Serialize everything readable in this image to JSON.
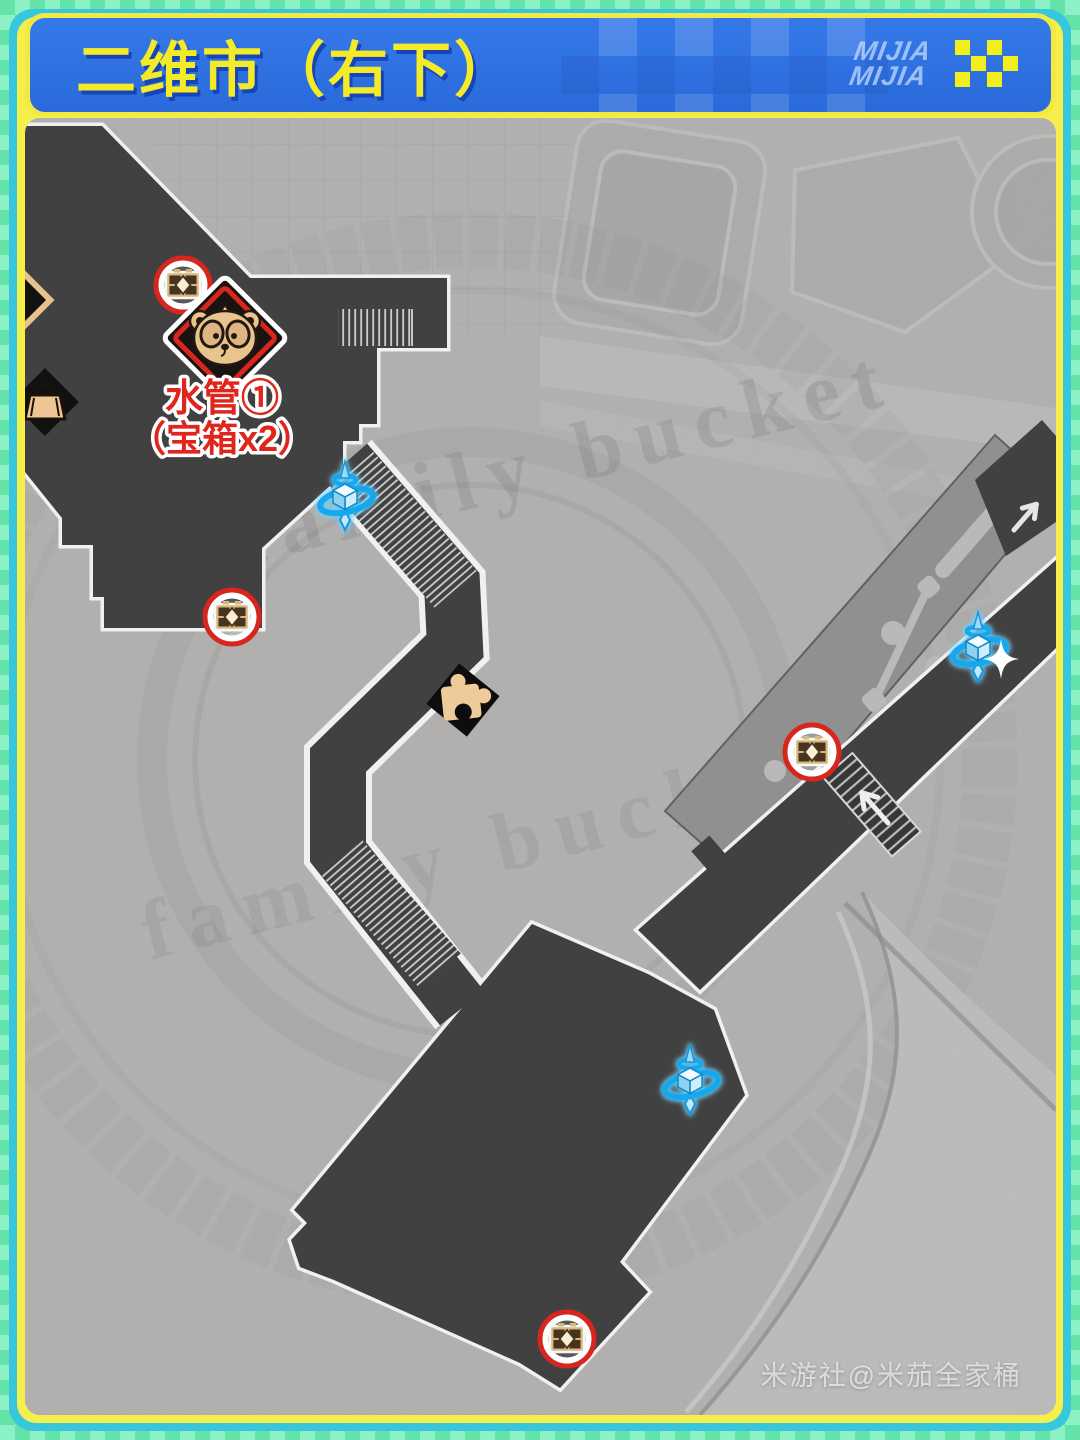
{
  "page": {
    "outer_green": "#63e3a8",
    "outer_green_light": "#8df1c6",
    "frame_cyan": "#38c5de",
    "frame_yellow": "#f6ef4b"
  },
  "header": {
    "title": "二维市（右下）",
    "title_color": "#f3ea28",
    "bg_color": "#2e72e2",
    "brand_line1": "MIJIA",
    "brand_line2": "MIJIA",
    "flower_color": "#f2ef19"
  },
  "map": {
    "ground_watermark": "family bucket",
    "label_line1": "水管①",
    "label_line2": "（宝箱x2）",
    "label_color": "#e0251c",
    "credit_watermark": "米游社@米茄全家桶",
    "colors": {
      "ground": "#b1b0ae",
      "path": "#3e3d3d",
      "path_outline": "#f2f2f2",
      "walkway": "#8f8f8f",
      "teleport_blue": "#1ba6e8",
      "chest_ring_red": "#d8251d",
      "icon_tan": "#e9c48d"
    },
    "markers": {
      "chests": [
        {
          "x": 183,
          "y": 285
        },
        {
          "x": 232,
          "y": 617
        },
        {
          "x": 812,
          "y": 752
        },
        {
          "x": 567,
          "y": 1339
        }
      ],
      "teleport_anchors": [
        {
          "x": 345,
          "y": 494
        },
        {
          "x": 978,
          "y": 645
        },
        {
          "x": 690,
          "y": 1078
        }
      ],
      "monster_diamond": {
        "x": 225,
        "y": 338
      },
      "puzzle_piece": {
        "x": 463,
        "y": 700
      },
      "shop_bag": {
        "x": 45,
        "y": 402
      },
      "player_sparkle": {
        "x": 1001,
        "y": 659
      }
    }
  }
}
